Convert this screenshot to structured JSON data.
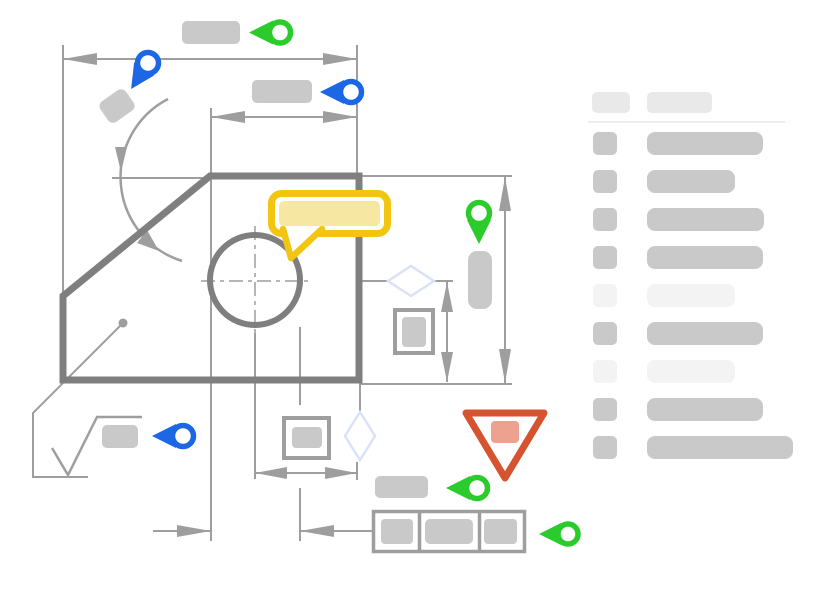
{
  "meta": {
    "description": "Engineering drawing annotation wireframe with marker pins, comment callout, warning triangle and skeleton annotation list"
  },
  "colors": {
    "canvas": "#FFFFFF",
    "line": "#9E9E9E",
    "outline": "#7F7F7F",
    "placeholder": "#C9C9C9",
    "placeholder_light": "#F3F3F3",
    "header": "#E9E9E9",
    "divider": "#EDEDED",
    "green": "#2BCB2B",
    "blue": "#1C67E3",
    "yellow": "#F2C511",
    "yellow_light": "#F6E7A2",
    "red": "#D5532E",
    "red_light": "#EDA18F",
    "diamond": "#D9E2F6"
  },
  "drawing": {
    "part": {
      "shape": "chamfered-plate",
      "hole": {
        "cx": 255,
        "cy": 280,
        "r": 45
      }
    },
    "dimensions": [
      {
        "id": "overall-width",
        "orientation": "horizontal"
      },
      {
        "id": "upper-width",
        "orientation": "horizontal"
      },
      {
        "id": "overall-height",
        "orientation": "vertical"
      },
      {
        "id": "inner-height",
        "orientation": "vertical"
      },
      {
        "id": "center-to-edge",
        "orientation": "horizontal"
      },
      {
        "id": "hole-diameter",
        "orientation": "horizontal"
      },
      {
        "id": "chamfer-angle",
        "orientation": "arc"
      }
    ],
    "markers": [
      {
        "id": "pin-overall-width",
        "color": "green",
        "direction": "left"
      },
      {
        "id": "pin-chamfer-angle",
        "color": "blue",
        "direction": "down-left"
      },
      {
        "id": "pin-upper-width",
        "color": "blue",
        "direction": "left"
      },
      {
        "id": "pin-right-face",
        "color": "green",
        "direction": "down"
      },
      {
        "id": "pin-surface-finish",
        "color": "blue",
        "direction": "left"
      },
      {
        "id": "pin-bottom-label",
        "color": "green",
        "direction": "left"
      },
      {
        "id": "pin-control-frame",
        "color": "green",
        "direction": "left"
      }
    ],
    "callout": {
      "type": "comment-bubble",
      "color": "yellow"
    },
    "warning": {
      "type": "alert-triangle",
      "color": "red"
    },
    "feature_control_frame": {
      "cells": 3
    },
    "datum_boxes": 2,
    "surface_finish_symbol": true
  },
  "sidebar": {
    "header": {
      "icon_width": 38,
      "bar_width": 65
    },
    "rows": [
      {
        "state": "normal",
        "bar_width": 116
      },
      {
        "state": "normal",
        "bar_width": 88
      },
      {
        "state": "normal",
        "bar_width": 117
      },
      {
        "state": "normal",
        "bar_width": 116
      },
      {
        "state": "faded",
        "bar_width": 88
      },
      {
        "state": "normal",
        "bar_width": 116
      },
      {
        "state": "faded",
        "bar_width": 88
      },
      {
        "state": "normal",
        "bar_width": 116
      },
      {
        "state": "normal",
        "bar_width": 146
      }
    ]
  }
}
